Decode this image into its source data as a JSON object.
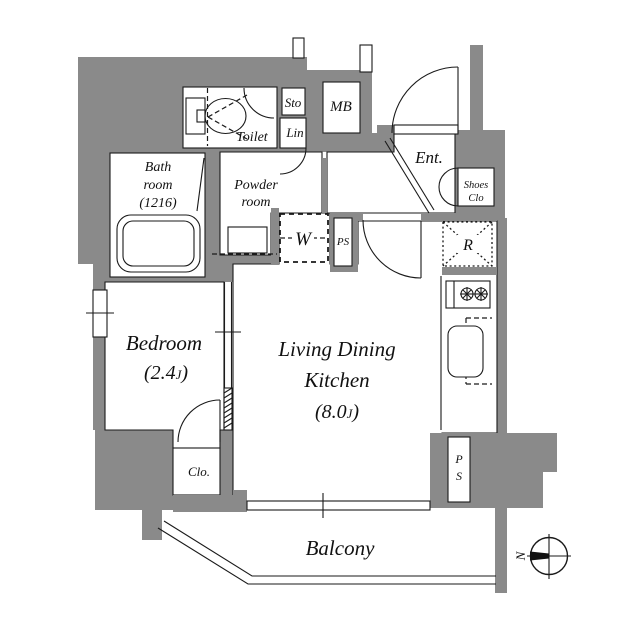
{
  "colors": {
    "wall": "#8a8a8a",
    "line": "#1a1a1a",
    "background": "#ffffff"
  },
  "rooms": {
    "toilet": {
      "label": "Toilet"
    },
    "storage": {
      "label": "Sto"
    },
    "linen": {
      "label": "Lin"
    },
    "meter_box": {
      "label": "MB"
    },
    "entrance": {
      "label": "Ent."
    },
    "shoes_closet": {
      "line1": "Shoes",
      "line2": "Clo"
    },
    "bathroom": {
      "line1": "Bath",
      "line2": "room",
      "line3": "(1216)"
    },
    "powder_room": {
      "line1": "Powder",
      "line2": "room"
    },
    "washer": {
      "label": "W"
    },
    "pipe_space_upper": {
      "label": "PS"
    },
    "refrigerator": {
      "label": "R"
    },
    "bedroom": {
      "name": "Bedroom",
      "area_pre": "(2.4",
      "area_unit": "J",
      "area_post": ")"
    },
    "ldk": {
      "line1": "Living Dining",
      "line2": "Kitchen",
      "area_pre": "(8.0",
      "area_unit": "J",
      "area_post": ")"
    },
    "closet": {
      "label": "Clo."
    },
    "pipe_space_lower": {
      "line1": "P",
      "line2": "S"
    },
    "balcony": {
      "label": "Balcony"
    }
  },
  "compass": {
    "north_label": "N"
  }
}
